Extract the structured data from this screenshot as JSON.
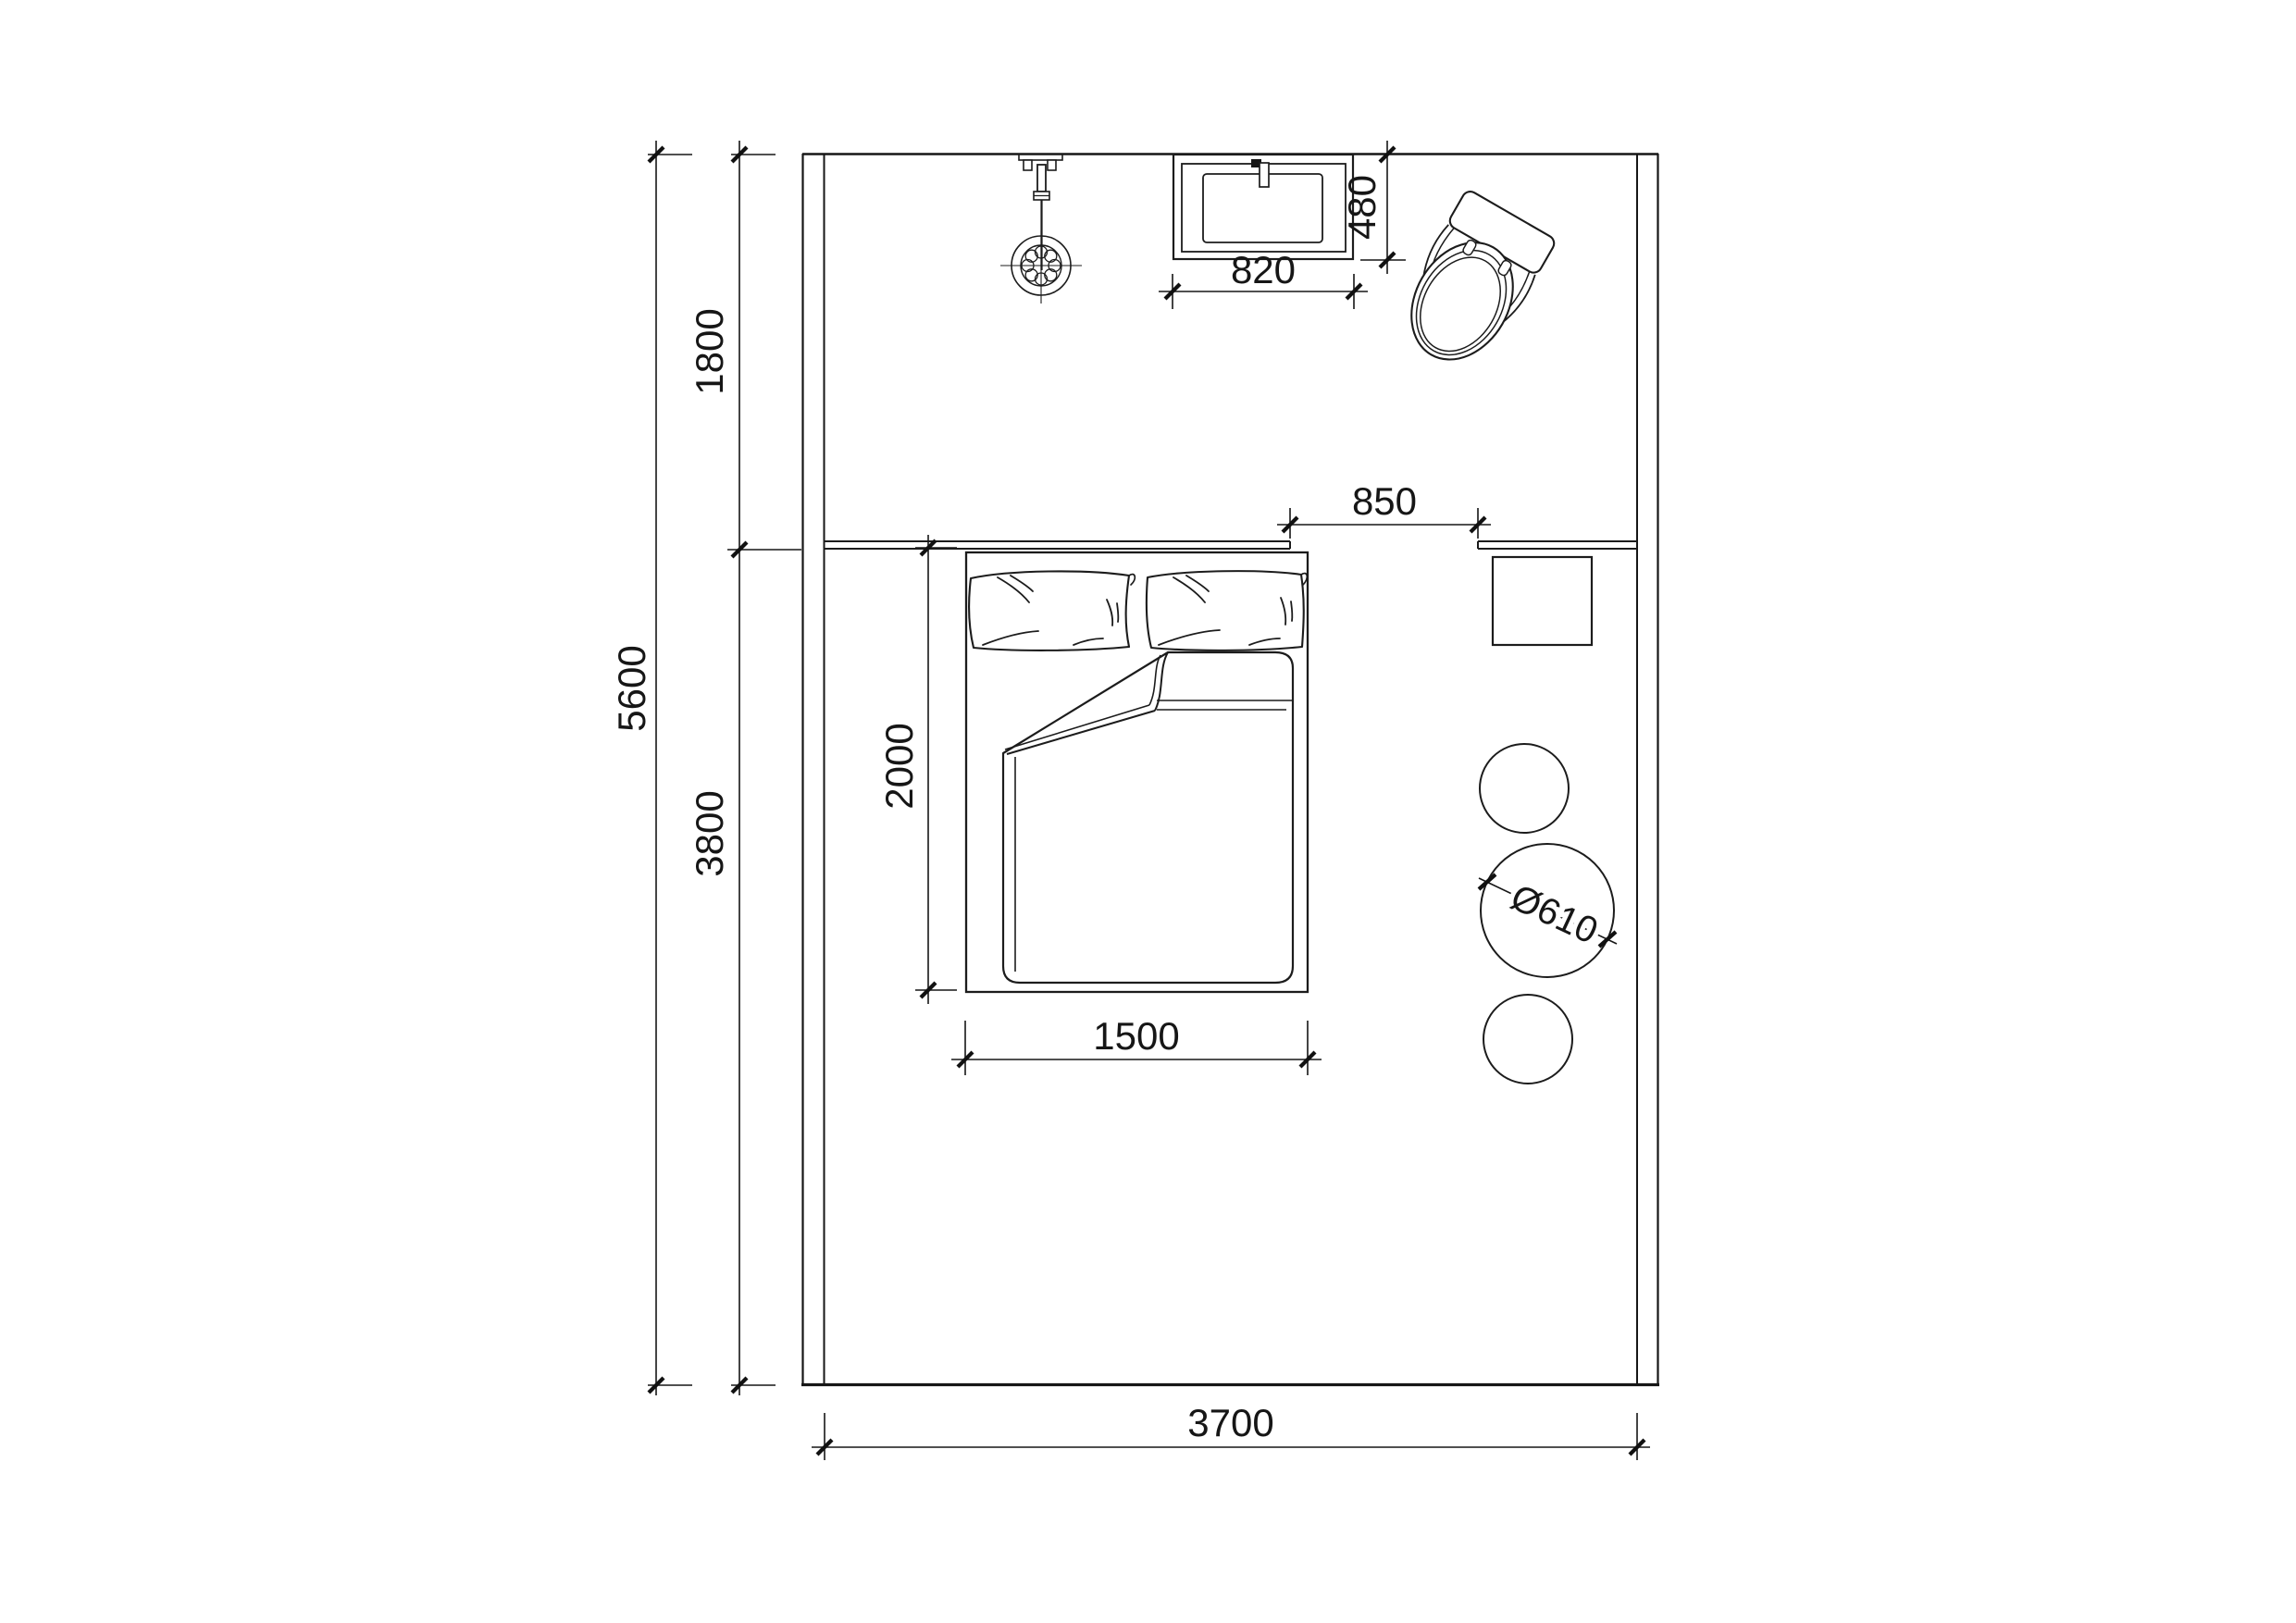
{
  "plan": {
    "kind": "bedroom-floor-plan",
    "dimensions": {
      "room_height_total": "5600",
      "bath_zone_depth": "1800",
      "bed_zone_depth": "3800",
      "room_width": "3700",
      "sink_width": "820",
      "sink_depth": "480",
      "passage_width": "850",
      "bed_width": "1500",
      "bed_length": "2000",
      "stool_diameter": "Ø610"
    },
    "colors": {
      "ink": "#161616",
      "paper": "#ffffff"
    }
  }
}
